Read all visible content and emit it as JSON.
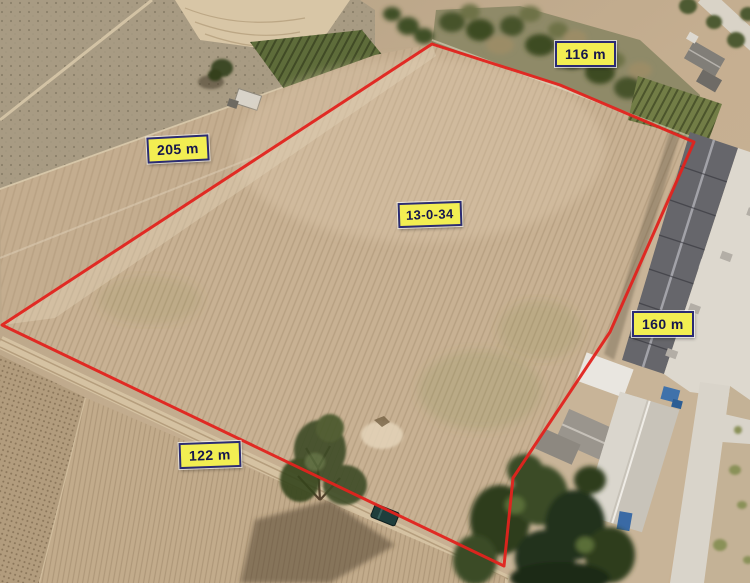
{
  "photo": {
    "description": "Aerial drone photograph of a vacant harvested land plot outlined in red with dimension labels",
    "plot": {
      "area_rai_ngan_wa": "13-0-34",
      "side_top": "116 m",
      "side_left": "205 m",
      "side_right": "160 m",
      "side_bottom": "122 m"
    },
    "colors": {
      "boundary": "#e2231e",
      "label_bg": "#f2ee52",
      "label_border": "#2b2b74",
      "label_text": "#16164e"
    }
  }
}
